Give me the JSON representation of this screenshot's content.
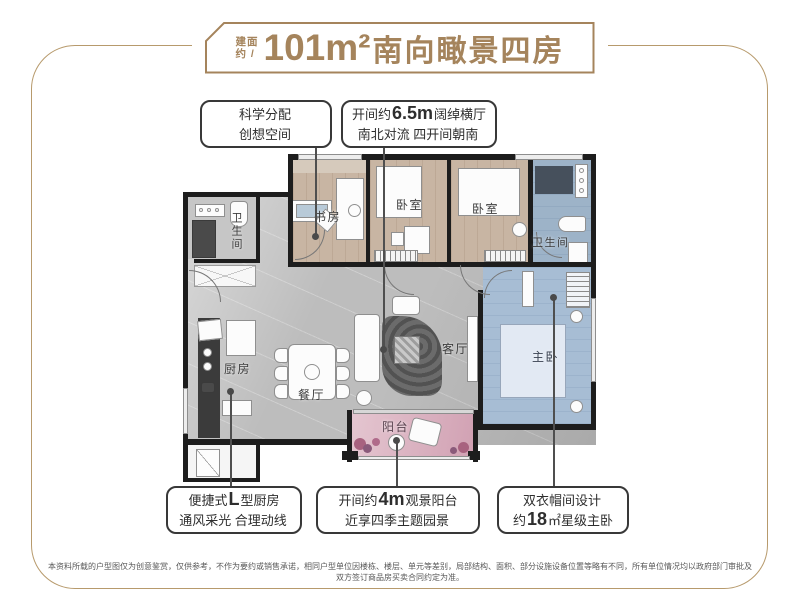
{
  "title": {
    "prefix_line1": "建面",
    "prefix_line2": "约 /",
    "area": "101m²",
    "name": "南向瞰景四房"
  },
  "callouts": [
    {
      "line1_pre": "科学分配",
      "line1_big": "",
      "line1_post": "",
      "line2_pre": "创想空间",
      "line2_big": "",
      "line2_post": ""
    },
    {
      "line1_pre": "开间约",
      "line1_big": "6.5m",
      "line1_post": "阔绰横厅",
      "line2_pre": "南北对流 四开间朝南",
      "line2_big": "",
      "line2_post": ""
    },
    {
      "line1_pre": "便捷式",
      "line1_big": "L",
      "line1_post": "型厨房",
      "line2_pre": "通风采光 合理动线",
      "line2_big": "",
      "line2_post": ""
    },
    {
      "line1_pre": "开间约",
      "line1_big": "4m",
      "line1_post": "观景阳台",
      "line2_pre": "近享四季主题园景",
      "line2_big": "",
      "line2_post": ""
    },
    {
      "line1_pre": "双衣帽间设计",
      "line1_big": "",
      "line1_post": "",
      "line2_pre": "约",
      "line2_big": "18",
      "line2_post": "㎡星级主卧"
    }
  ],
  "rooms": {
    "bath1": "卫生间",
    "study": "书房",
    "bed1": "卧室",
    "bed2": "卧室",
    "bath2": "卫生间",
    "master": "主卧",
    "living": "客厅",
    "dining": "餐厅",
    "kitchen": "厨房",
    "balcony": "阳台"
  },
  "disclaimer": "本资料所载的户型图仅为创意鉴赏，仅供参考，不作为要约或销售承诺，相同户型单位因楼栋、楼层、单元等差别，局部结构、面积、部分设施设备位置等略有不同，所有单位情况均以政府部门审批及双方签订商品房买卖合同约定为准。",
  "colors": {
    "title_gold": "#a5845c",
    "frame_gold": "#b79a6c",
    "wall": "#1d1d1d",
    "marble_floor": "#bdbdbd",
    "wood_floor": "#c8b5a3",
    "master_blue": "#a7bdd4",
    "balcony_pink": "#d9adbc",
    "callout_border": "#383838",
    "leader_line": "#4f4f4f"
  }
}
